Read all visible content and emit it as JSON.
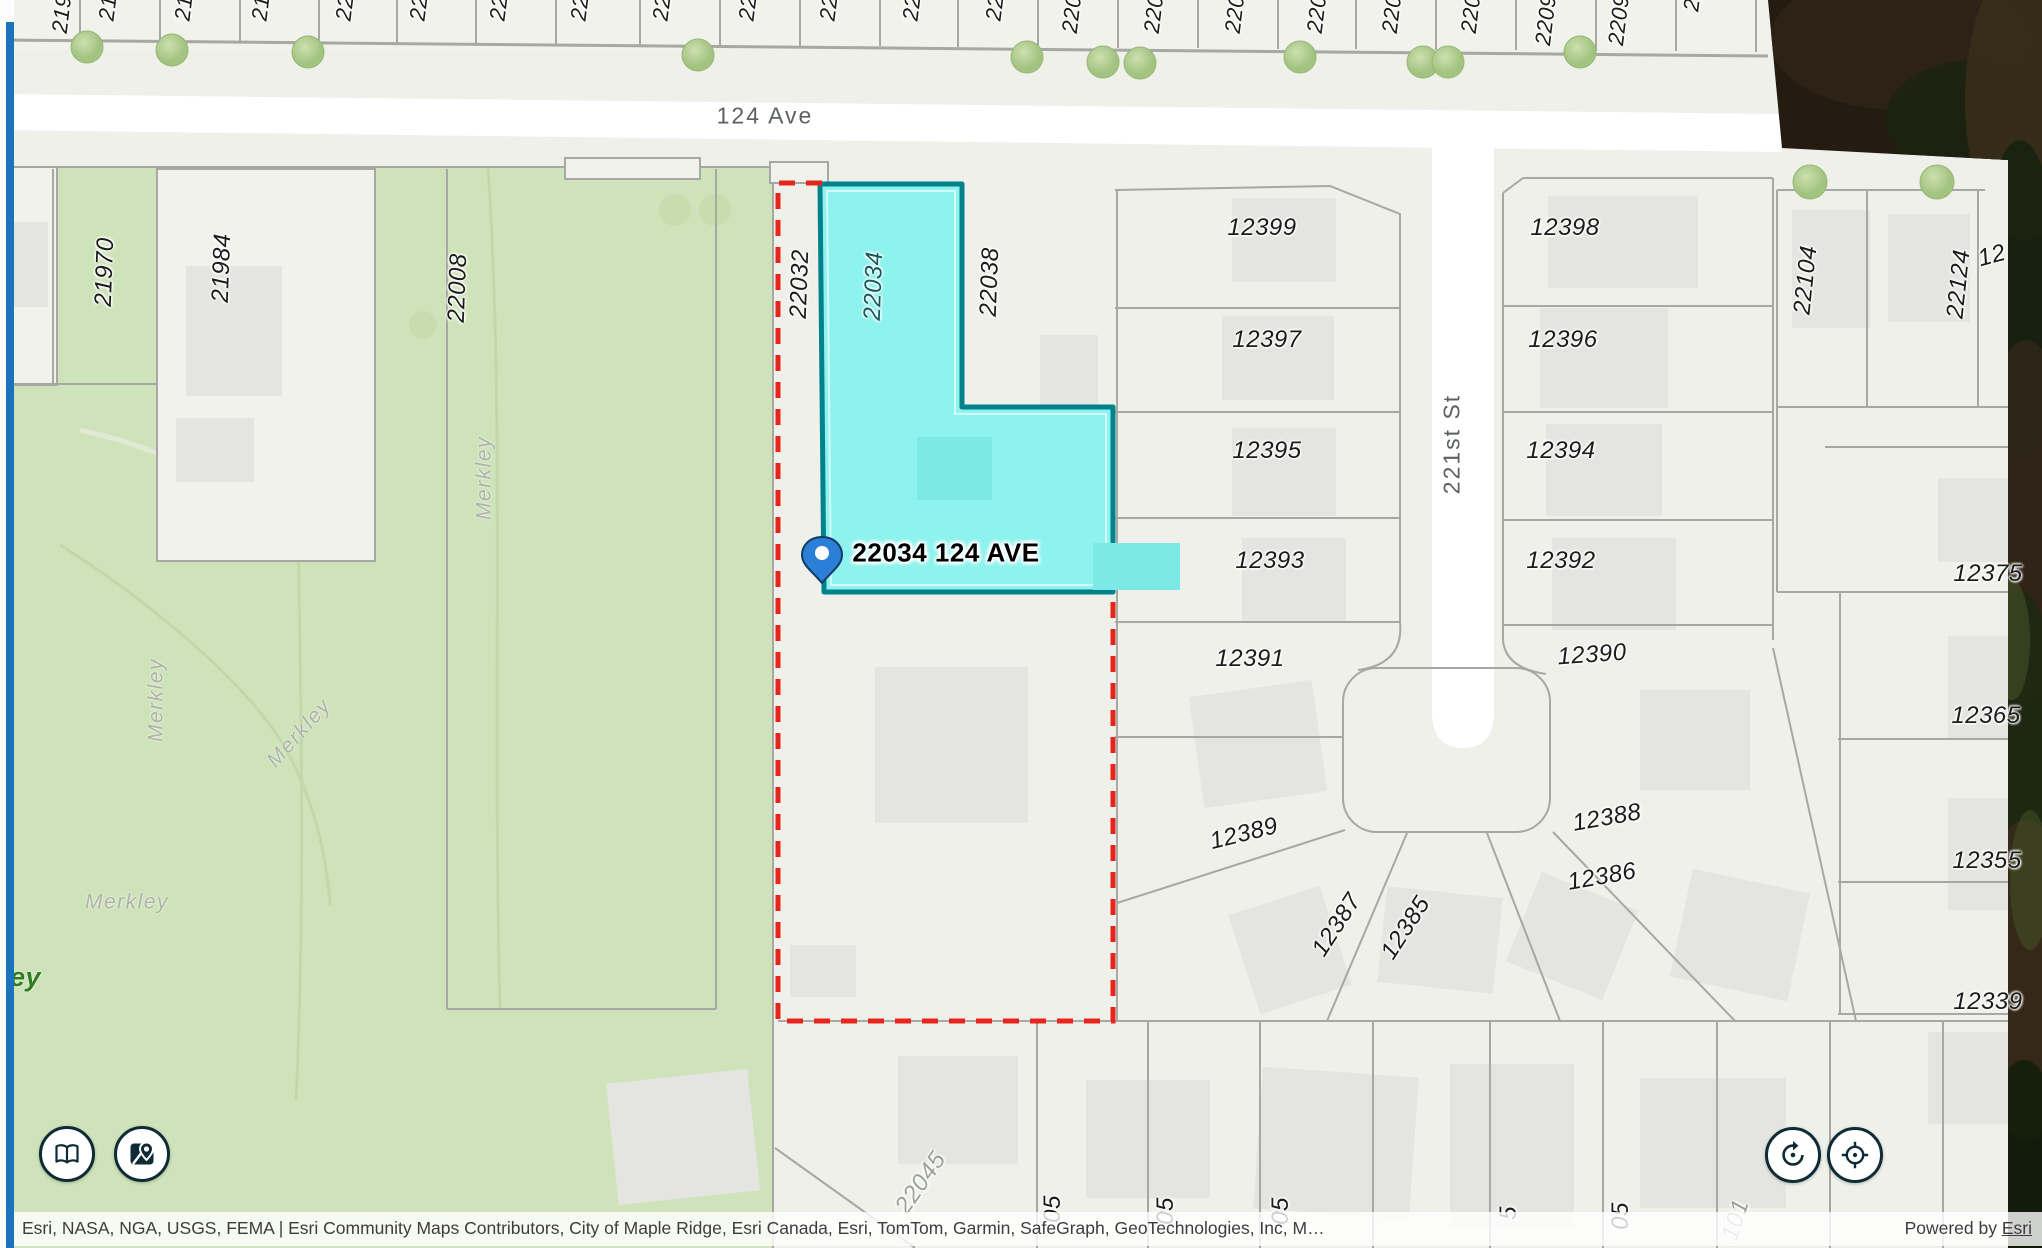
{
  "pin": {
    "label": "22034 124 AVE"
  },
  "streets": {
    "ave": {
      "t": "124 Ave"
    },
    "st": {
      "t": "221st St"
    },
    "merkley": {
      "t": "Merkley"
    },
    "park": {
      "t": "ley"
    }
  },
  "top": [
    {
      "t": "219"
    },
    {
      "t": "21"
    },
    {
      "t": "21"
    },
    {
      "t": "21"
    },
    {
      "t": "22"
    },
    {
      "t": "22"
    },
    {
      "t": "22"
    },
    {
      "t": "22"
    },
    {
      "t": "22"
    },
    {
      "t": "22"
    },
    {
      "t": "22"
    },
    {
      "t": "22"
    },
    {
      "t": "22"
    },
    {
      "t": "220"
    },
    {
      "t": "220"
    },
    {
      "t": "220"
    },
    {
      "t": "220"
    },
    {
      "t": "220"
    },
    {
      "t": "220"
    },
    {
      "t": "2209"
    },
    {
      "t": "2209"
    },
    {
      "t": "2"
    }
  ],
  "parcels": [
    {
      "t": "21970"
    },
    {
      "t": "21984"
    },
    {
      "t": "22008"
    },
    {
      "t": "22032"
    },
    {
      "t": "22034"
    },
    {
      "t": "22038"
    },
    {
      "t": "12399"
    },
    {
      "t": "12397"
    },
    {
      "t": "12395"
    },
    {
      "t": "12393"
    },
    {
      "t": "12391"
    },
    {
      "t": "12389"
    },
    {
      "t": "12387"
    },
    {
      "t": "12385"
    },
    {
      "t": "12398"
    },
    {
      "t": "12396"
    },
    {
      "t": "12394"
    },
    {
      "t": "12392"
    },
    {
      "t": "12390"
    },
    {
      "t": "12388"
    },
    {
      "t": "12386"
    },
    {
      "t": "22104"
    },
    {
      "t": "22124"
    },
    {
      "t": "12"
    },
    {
      "t": "12375"
    },
    {
      "t": "12365"
    },
    {
      "t": "12355"
    },
    {
      "t": "12339"
    }
  ],
  "bottom": [
    {
      "t": "22045"
    },
    {
      "t": "05"
    },
    {
      "t": "05"
    },
    {
      "t": "05"
    },
    {
      "t": "5"
    },
    {
      "t": "05"
    },
    {
      "t": "101"
    }
  ],
  "attribution": {
    "sources": "Esri, NASA, NGA, USGS, FEMA | Esri Community Maps Contributors, City of Maple Ridge, Esri Canada, Esri, TomTom, Garmin, SafeGraph, GeoTechnologies, Inc, M…",
    "powered": "Powered by ",
    "esri": "Esri"
  },
  "controls": {
    "legend_icon": "book-icon",
    "basemap_icon": "basemap-pin-icon",
    "reset_icon": "reset-rotation-icon",
    "locate_icon": "locate-crosshair-icon"
  },
  "colors": {
    "selection_fill": "#8ef3ee",
    "selection_border": "#00828c",
    "boundary_red": "#e8251c",
    "park_green": "#cfe3ba",
    "accent_blue": "#1b74bb",
    "pin_blue": "#2b7fd6",
    "road_white": "#ffffff"
  }
}
